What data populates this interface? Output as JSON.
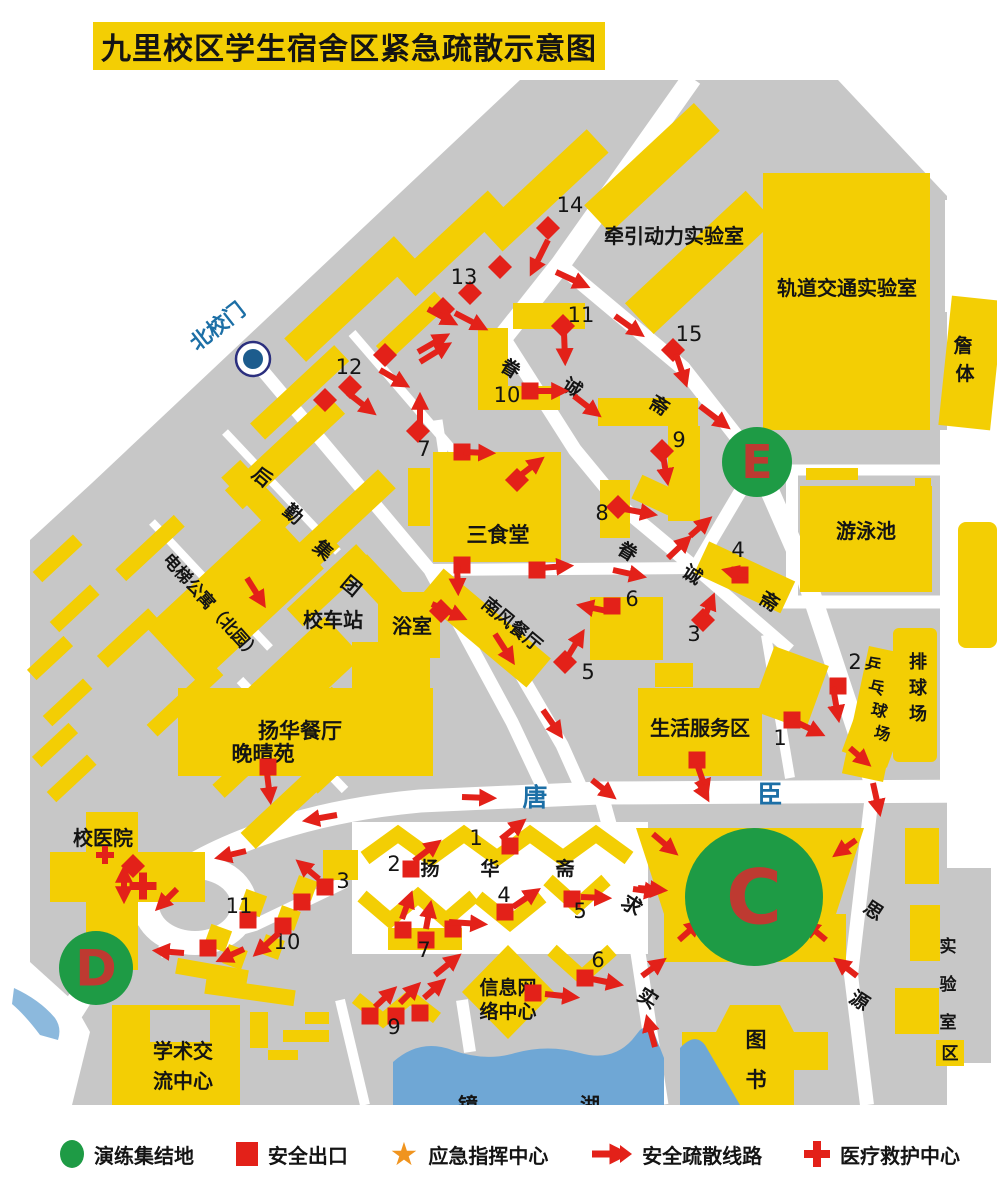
{
  "title": "九里校区学生宿舍区紧急疏散示意图",
  "colors": {
    "yellow": "#F3CE04",
    "gray": "#C7C7C7",
    "red": "#E32119",
    "green": "#1E9B45",
    "letter_red": "#BE3A31",
    "blue": "#1C6FA6",
    "lake": "#6FA7D5",
    "star_orange": "#F0941F",
    "text": "#141414"
  },
  "legend": {
    "items": [
      {
        "icon": "assembly-circle",
        "label": "演练集结地"
      },
      {
        "icon": "exit-square",
        "label": "安全出口"
      },
      {
        "icon": "command-star",
        "label": "应急指挥中心"
      },
      {
        "icon": "route-arrow",
        "label": "安全疏散线路"
      },
      {
        "icon": "medical-cross",
        "label": "医疗救护中心"
      }
    ]
  },
  "map": {
    "gate_label": "北校门",
    "labels": [
      {
        "t": "牵引动力实验室",
        "x": 674,
        "y": 243,
        "s": 20
      },
      {
        "t": "轨道交通实验室",
        "x": 847,
        "y": 295,
        "s": 20
      },
      {
        "t": "游泳池",
        "x": 866,
        "y": 538,
        "s": 20
      },
      {
        "t": "三食堂",
        "x": 498,
        "y": 542,
        "s": 21
      },
      {
        "t": "南风餐厅",
        "x": 508,
        "y": 629,
        "s": 18,
        "rot": 40
      },
      {
        "t": "浴室",
        "x": 412,
        "y": 633,
        "s": 20
      },
      {
        "t": "校车站",
        "x": 333,
        "y": 627,
        "s": 20
      },
      {
        "t": "扬华餐厅",
        "x": 300,
        "y": 738,
        "s": 21
      },
      {
        "t": "晚晴苑",
        "x": 263,
        "y": 761,
        "s": 21
      },
      {
        "t": "生活服务区",
        "x": 700,
        "y": 735,
        "s": 20
      },
      {
        "t": "校医院",
        "x": 103,
        "y": 845,
        "s": 20
      },
      {
        "t": "学术交",
        "x": 183,
        "y": 1058,
        "s": 20
      },
      {
        "t": "流中心",
        "x": 183,
        "y": 1088,
        "s": 20
      },
      {
        "t": "信息网",
        "x": 508,
        "y": 994,
        "s": 19
      },
      {
        "t": "络中心",
        "x": 508,
        "y": 1018,
        "s": 19
      },
      {
        "t": "电梯公寓（北园）",
        "x": 162,
        "y": 560,
        "s": 17,
        "rot": 48,
        "a": "start"
      },
      {
        "t": "北校门",
        "x": 222,
        "y": 332,
        "s": 21,
        "rot": -38,
        "c": "#1C6FA6"
      },
      {
        "t": "唐",
        "x": 535,
        "y": 806,
        "s": 25,
        "c": "#1C6FA6"
      },
      {
        "t": "臣",
        "x": 770,
        "y": 803,
        "s": 25,
        "c": "#1C6FA6"
      },
      {
        "t": "求",
        "x": 628,
        "y": 911,
        "s": 20,
        "rot": 33
      },
      {
        "t": "实",
        "x": 644,
        "y": 1004,
        "s": 20,
        "rot": 33
      },
      {
        "t": "思",
        "x": 870,
        "y": 916,
        "s": 19,
        "rot": 33
      },
      {
        "t": "源",
        "x": 856,
        "y": 1006,
        "s": 19,
        "rot": 33
      },
      {
        "t": "眷",
        "x": 507,
        "y": 374,
        "s": 19,
        "rot": 32
      },
      {
        "t": "诚",
        "x": 569,
        "y": 393,
        "s": 19,
        "rot": 32
      },
      {
        "t": "斋",
        "x": 656,
        "y": 411,
        "s": 19,
        "rot": 32
      },
      {
        "t": "眷",
        "x": 624,
        "y": 557,
        "s": 19,
        "rot": 32
      },
      {
        "t": "诚",
        "x": 689,
        "y": 580,
        "s": 19,
        "rot": 32
      },
      {
        "t": "斋",
        "x": 766,
        "y": 607,
        "s": 19,
        "rot": 32
      },
      {
        "t": "后",
        "x": 258,
        "y": 482,
        "s": 19,
        "rot": 40
      },
      {
        "t": "勤",
        "x": 289,
        "y": 519,
        "s": 19,
        "rot": 40
      },
      {
        "t": "集",
        "x": 319,
        "y": 555,
        "s": 19,
        "rot": 40
      },
      {
        "t": "团",
        "x": 347,
        "y": 591,
        "s": 19,
        "rot": 40
      },
      {
        "t": "扬",
        "x": 430,
        "y": 875,
        "s": 19
      },
      {
        "t": "华",
        "x": 490,
        "y": 875,
        "s": 19
      },
      {
        "t": "斋",
        "x": 565,
        "y": 875,
        "s": 19
      },
      {
        "t": "图",
        "x": 756,
        "y": 1047,
        "s": 21
      },
      {
        "t": "书",
        "x": 756,
        "y": 1087,
        "s": 21
      },
      {
        "t": "排",
        "x": 918,
        "y": 668,
        "s": 18
      },
      {
        "t": "球",
        "x": 918,
        "y": 694,
        "s": 18
      },
      {
        "t": "场",
        "x": 918,
        "y": 720,
        "s": 18
      },
      {
        "t": "乒",
        "x": 872,
        "y": 670,
        "s": 16,
        "rot": 14
      },
      {
        "t": "乓",
        "x": 875,
        "y": 693,
        "s": 16,
        "rot": 14
      },
      {
        "t": "球",
        "x": 878,
        "y": 716,
        "s": 16,
        "rot": 14
      },
      {
        "t": "场",
        "x": 881,
        "y": 739,
        "s": 16,
        "rot": 14
      },
      {
        "t": "实",
        "x": 948,
        "y": 952,
        "s": 17
      },
      {
        "t": "验",
        "x": 948,
        "y": 990,
        "s": 17
      },
      {
        "t": "室",
        "x": 948,
        "y": 1028,
        "s": 17
      },
      {
        "t": "区",
        "x": 950,
        "y": 1059,
        "s": 17
      },
      {
        "t": "镜",
        "x": 468,
        "y": 1112,
        "s": 20
      },
      {
        "t": "湖",
        "x": 590,
        "y": 1112,
        "s": 20
      },
      {
        "t": "詹",
        "x": 963,
        "y": 352,
        "s": 19
      },
      {
        "t": "体",
        "x": 965,
        "y": 380,
        "s": 19
      }
    ],
    "exit_numbers": [
      {
        "n": "14",
        "x": 570,
        "y": 212
      },
      {
        "n": "13",
        "x": 464,
        "y": 284
      },
      {
        "n": "12",
        "x": 349,
        "y": 374
      },
      {
        "n": "11",
        "x": 581,
        "y": 322
      },
      {
        "n": "10",
        "x": 507,
        "y": 402
      },
      {
        "n": "15",
        "x": 689,
        "y": 341
      },
      {
        "n": "9",
        "x": 679,
        "y": 447
      },
      {
        "n": "8",
        "x": 602,
        "y": 520
      },
      {
        "n": "7",
        "x": 424,
        "y": 456
      },
      {
        "n": "6",
        "x": 632,
        "y": 606
      },
      {
        "n": "5",
        "x": 588,
        "y": 679
      },
      {
        "n": "4",
        "x": 738,
        "y": 557
      },
      {
        "n": "3",
        "x": 694,
        "y": 641
      },
      {
        "n": "2",
        "x": 855,
        "y": 669
      },
      {
        "n": "1",
        "x": 780,
        "y": 745
      },
      {
        "n": "1",
        "x": 476,
        "y": 845
      },
      {
        "n": "2",
        "x": 394,
        "y": 871
      },
      {
        "n": "3",
        "x": 343,
        "y": 888
      },
      {
        "n": "4",
        "x": 504,
        "y": 902
      },
      {
        "n": "5",
        "x": 580,
        "y": 918
      },
      {
        "n": "6",
        "x": 598,
        "y": 967
      },
      {
        "n": "7",
        "x": 424,
        "y": 957
      },
      {
        "n": "9",
        "x": 394,
        "y": 1034
      },
      {
        "n": "10",
        "x": 287,
        "y": 949
      },
      {
        "n": "11",
        "x": 239,
        "y": 913
      }
    ],
    "exits": [
      {
        "x": 548,
        "y": 228,
        "d": 1
      },
      {
        "x": 500,
        "y": 267,
        "d": 1
      },
      {
        "x": 470,
        "y": 293,
        "d": 1
      },
      {
        "x": 443,
        "y": 309,
        "d": 1
      },
      {
        "x": 385,
        "y": 355,
        "d": 1
      },
      {
        "x": 350,
        "y": 387,
        "d": 1
      },
      {
        "x": 325,
        "y": 400,
        "d": 1
      },
      {
        "x": 418,
        "y": 431,
        "d": 1
      },
      {
        "x": 563,
        "y": 326,
        "d": 1
      },
      {
        "x": 530,
        "y": 391,
        "d": 0
      },
      {
        "x": 673,
        "y": 350,
        "d": 1
      },
      {
        "x": 662,
        "y": 451,
        "d": 1
      },
      {
        "x": 618,
        "y": 507,
        "d": 1
      },
      {
        "x": 462,
        "y": 452,
        "d": 0
      },
      {
        "x": 517,
        "y": 480,
        "d": 1
      },
      {
        "x": 462,
        "y": 565,
        "d": 0
      },
      {
        "x": 537,
        "y": 570,
        "d": 0
      },
      {
        "x": 441,
        "y": 611,
        "d": 1
      },
      {
        "x": 565,
        "y": 662,
        "d": 1
      },
      {
        "x": 612,
        "y": 606,
        "d": 0
      },
      {
        "x": 740,
        "y": 575,
        "d": 0
      },
      {
        "x": 703,
        "y": 620,
        "d": 1
      },
      {
        "x": 838,
        "y": 686,
        "d": 0
      },
      {
        "x": 792,
        "y": 720,
        "d": 0
      },
      {
        "x": 697,
        "y": 760,
        "d": 0
      },
      {
        "x": 268,
        "y": 767,
        "d": 0
      },
      {
        "x": 133,
        "y": 866,
        "d": 1
      },
      {
        "x": 325,
        "y": 887,
        "d": 0
      },
      {
        "x": 248,
        "y": 920,
        "d": 0
      },
      {
        "x": 283,
        "y": 926,
        "d": 0
      },
      {
        "x": 208,
        "y": 948,
        "d": 0
      },
      {
        "x": 302,
        "y": 902,
        "d": 0
      },
      {
        "x": 510,
        "y": 846,
        "d": 0
      },
      {
        "x": 411,
        "y": 869,
        "d": 0
      },
      {
        "x": 403,
        "y": 930,
        "d": 0
      },
      {
        "x": 426,
        "y": 940,
        "d": 0
      },
      {
        "x": 453,
        "y": 929,
        "d": 0
      },
      {
        "x": 505,
        "y": 912,
        "d": 0
      },
      {
        "x": 572,
        "y": 899,
        "d": 0
      },
      {
        "x": 585,
        "y": 978,
        "d": 0
      },
      {
        "x": 533,
        "y": 993,
        "d": 0
      },
      {
        "x": 370,
        "y": 1016,
        "d": 0
      },
      {
        "x": 396,
        "y": 1016,
        "d": 0
      },
      {
        "x": 420,
        "y": 1013,
        "d": 0
      }
    ],
    "arrows": [
      [
        548,
        240,
        533,
        270
      ],
      [
        556,
        272,
        584,
        285
      ],
      [
        615,
        316,
        639,
        333
      ],
      [
        676,
        354,
        685,
        381
      ],
      [
        700,
        406,
        725,
        425
      ],
      [
        564,
        332,
        565,
        359
      ],
      [
        538,
        391,
        562,
        391
      ],
      [
        574,
        396,
        596,
        413
      ],
      [
        428,
        309,
        452,
        322
      ],
      [
        455,
        313,
        482,
        327
      ],
      [
        418,
        352,
        444,
        337
      ],
      [
        348,
        393,
        371,
        411
      ],
      [
        380,
        370,
        404,
        384
      ],
      [
        420,
        362,
        446,
        346
      ],
      [
        420,
        426,
        420,
        399
      ],
      [
        247,
        578,
        262,
        602
      ],
      [
        464,
        452,
        489,
        453
      ],
      [
        517,
        478,
        539,
        461
      ],
      [
        540,
        568,
        567,
        566
      ],
      [
        613,
        570,
        640,
        576
      ],
      [
        457,
        566,
        458,
        589
      ],
      [
        432,
        604,
        461,
        617
      ],
      [
        495,
        634,
        511,
        659
      ],
      [
        543,
        710,
        559,
        733
      ],
      [
        592,
        780,
        611,
        795
      ],
      [
        462,
        797,
        490,
        798
      ],
      [
        567,
        658,
        581,
        635
      ],
      [
        607,
        611,
        583,
        606
      ],
      [
        624,
        509,
        651,
        514
      ],
      [
        663,
        455,
        667,
        479
      ],
      [
        668,
        558,
        687,
        540
      ],
      [
        690,
        536,
        707,
        521
      ],
      [
        705,
        616,
        712,
        599
      ],
      [
        747,
        576,
        728,
        571
      ],
      [
        833,
        687,
        838,
        716
      ],
      [
        794,
        721,
        819,
        733
      ],
      [
        850,
        748,
        866,
        762
      ],
      [
        697,
        764,
        706,
        790
      ],
      [
        873,
        783,
        879,
        810
      ],
      [
        698,
        781,
        706,
        796
      ],
      [
        267,
        773,
        270,
        798
      ],
      [
        337,
        815,
        309,
        820
      ],
      [
        246,
        851,
        221,
        857
      ],
      [
        177,
        889,
        160,
        906
      ],
      [
        184,
        953,
        159,
        951
      ],
      [
        124,
        872,
        124,
        897,
        1
      ],
      [
        319,
        879,
        301,
        864
      ],
      [
        279,
        933,
        258,
        952
      ],
      [
        244,
        949,
        222,
        959
      ],
      [
        501,
        839,
        521,
        823
      ],
      [
        414,
        861,
        436,
        844
      ],
      [
        402,
        919,
        410,
        897
      ],
      [
        426,
        929,
        430,
        907
      ],
      [
        449,
        922,
        481,
        924
      ],
      [
        513,
        907,
        535,
        892
      ],
      [
        581,
        897,
        605,
        898
      ],
      [
        633,
        889,
        655,
        892
      ],
      [
        592,
        979,
        617,
        984
      ],
      [
        545,
        994,
        573,
        997
      ],
      [
        435,
        975,
        456,
        958
      ],
      [
        375,
        1007,
        392,
        991
      ],
      [
        400,
        1003,
        416,
        987
      ],
      [
        424,
        998,
        441,
        983
      ],
      [
        655,
        1047,
        648,
        1021
      ],
      [
        653,
        834,
        673,
        851
      ],
      [
        856,
        840,
        838,
        853
      ],
      [
        638,
        888,
        661,
        890
      ],
      [
        679,
        940,
        697,
        924
      ],
      [
        826,
        940,
        808,
        925
      ],
      [
        642,
        976,
        661,
        962
      ],
      [
        857,
        976,
        839,
        962
      ]
    ],
    "assembly_points": [
      {
        "id": "E",
        "x": 757,
        "y": 462,
        "r": 35,
        "fs": 46
      },
      {
        "id": "D",
        "x": 96,
        "y": 968,
        "r": 37,
        "fs": 50
      },
      {
        "id": "C",
        "x": 754,
        "y": 897,
        "r": 69,
        "fs": 76
      }
    ],
    "medical_crosses": [
      {
        "x": 105,
        "y": 855,
        "s": 18,
        "t": 6
      },
      {
        "x": 143,
        "y": 886,
        "s": 27,
        "t": 8
      }
    ]
  }
}
